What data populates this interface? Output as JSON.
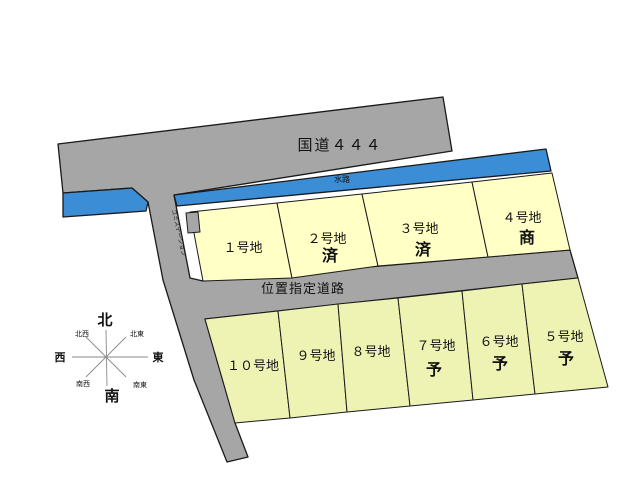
{
  "map": {
    "national_road": {
      "label": "国道４４４"
    },
    "waterway": {
      "label": "水路"
    },
    "designated_road": {
      "label": "位置指定道路"
    },
    "garbage_station": {
      "label": "ゴミステーション"
    },
    "lots_upper": [
      {
        "name": "１号地",
        "status": ""
      },
      {
        "name": "２号地",
        "status": "済"
      },
      {
        "name": "３号地",
        "status": "済"
      },
      {
        "name": "４号地",
        "status": "商"
      }
    ],
    "lots_lower": [
      {
        "name": "１０号地",
        "status": ""
      },
      {
        "name": "９号地",
        "status": ""
      },
      {
        "name": "８号地",
        "status": ""
      },
      {
        "name": "７号地",
        "status": "予"
      },
      {
        "name": "６号地",
        "status": "予"
      },
      {
        "name": "５号地",
        "status": "予"
      }
    ],
    "compass": {
      "north": "北",
      "south": "南",
      "east": "東",
      "west": "西",
      "northeast": "北東",
      "northwest": "北西",
      "southeast": "南東",
      "southwest": "南西"
    },
    "colors": {
      "road": "#a6a6a6",
      "waterway": "#3b8ed6",
      "lot_upper": "#ffffc6",
      "lot_lower": "#eef3b4",
      "status_red": "#e60012"
    }
  }
}
